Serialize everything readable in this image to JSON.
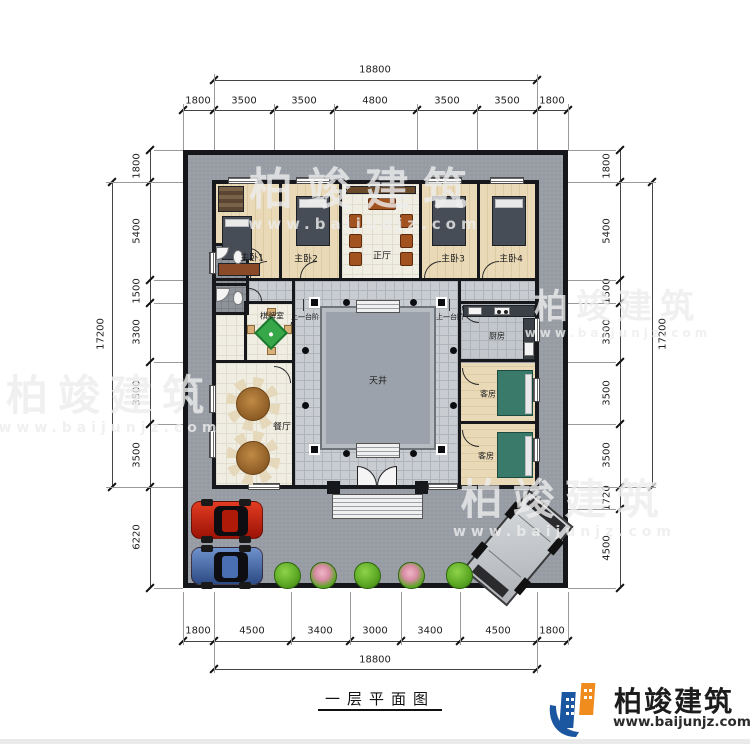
{
  "drawing": {
    "caption": "一层平面图",
    "dims": {
      "top": {
        "overall": "18800",
        "segments": [
          "1800",
          "3500",
          "3500",
          "4800",
          "3500",
          "3500",
          "1800"
        ]
      },
      "bottom": {
        "overall": "18800",
        "segments": [
          "1800",
          "4500",
          "3400",
          "3000",
          "3400",
          "4500",
          "1800"
        ]
      },
      "left": {
        "overall": "17200",
        "segments": [
          "1800",
          "5400",
          "1500",
          "3300",
          "3500",
          "3500",
          "6220"
        ]
      },
      "right": {
        "overall": "17200",
        "segments": [
          "1800",
          "5400",
          "1500",
          "3300",
          "3500",
          "3500",
          "1720",
          "4500"
        ]
      }
    },
    "rooms": {
      "master1": "主卧1",
      "master2": "主卧2",
      "main_hall": "正厅",
      "master3": "主卧3",
      "master4": "主卧4",
      "mahjong_room": "棋牌室",
      "dining_room": "餐厅",
      "courtyard": "天井",
      "kitchen": "厨房",
      "guest_room_1": "客房",
      "guest_room_2": "客房",
      "step_note_left": "上一台阶",
      "step_note_right": "上一台阶"
    }
  },
  "branding": {
    "company": "柏竣建筑",
    "website": "www.baijunjz.com"
  },
  "watermark": {
    "text": "柏竣建筑",
    "url": "www.baijunjz.com"
  },
  "colors": {
    "site_gray": "#979ca4",
    "walkway_tile": "#c9cdd2",
    "courtyard_platform": "#9ca2ab",
    "wood_floor": "#e9d9b6",
    "mahjong_green": "#36a84a",
    "logo_blue": "#1a57a0",
    "logo_orange": "#f08c1e",
    "car_red": "#cf2311",
    "car_blue": "#4a6fb3",
    "shrub_green": "#5aa622"
  }
}
